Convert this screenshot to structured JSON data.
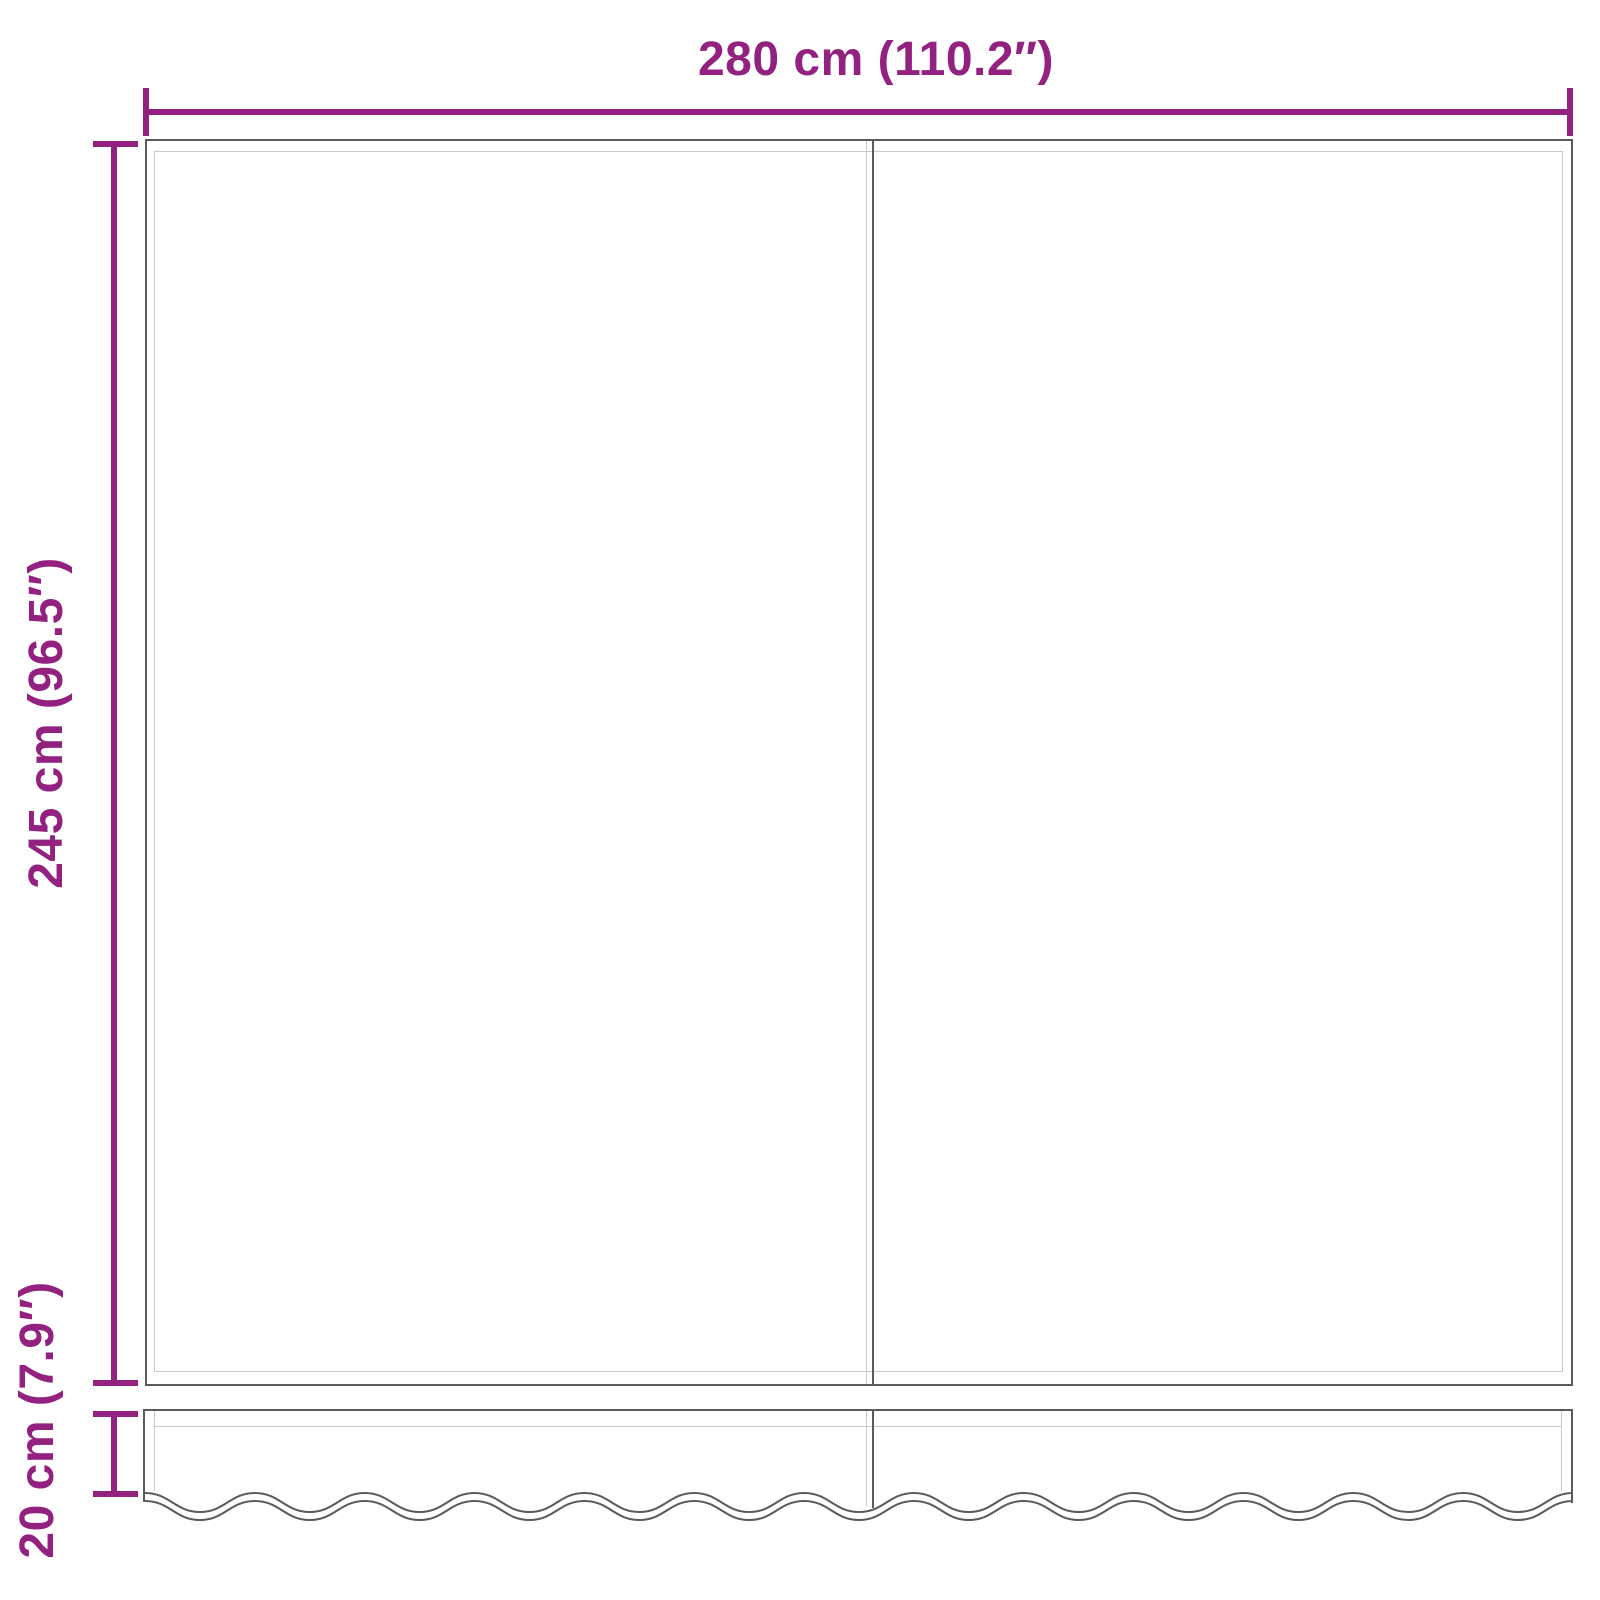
{
  "diagram": {
    "width_dimension": {
      "label": "280 cm (110.2″)"
    },
    "height_dimension": {
      "label": "245 cm (96.5″)"
    },
    "valance_dimension": {
      "label": "20 cm (7.9″)"
    }
  },
  "colors": {
    "dimension_accent": "#93217F",
    "outline_dark": "#5A5A5A",
    "outline_light": "#C9C9C9"
  }
}
